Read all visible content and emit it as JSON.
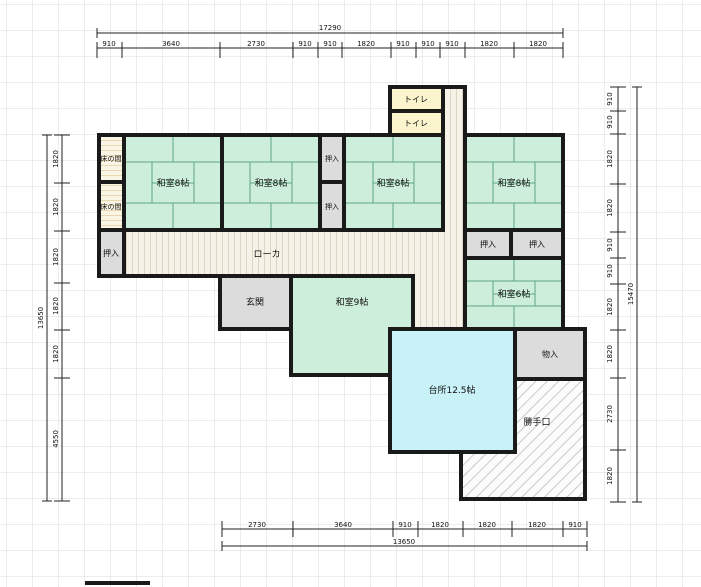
{
  "plan_type": "floor-plan",
  "rooms": {
    "toilet_1": "トイレ",
    "toilet_2": "トイレ",
    "tokonoma_1": "床の間",
    "tokonoma_2": "床の間",
    "washitsu8_1": "和室8帖",
    "washitsu8_2": "和室8帖",
    "washitsu8_3": "和室8帖",
    "washitsu8_4": "和室8帖",
    "oshiire_1": "押入",
    "oshiire_2": "押入",
    "oshiire_3": "押入",
    "oshiire_4": "押入",
    "oshiire_5": "押入",
    "corridor": "ローカ",
    "entrance": "玄関",
    "washitsu9": "和室9帖",
    "washitsu6": "和室6帖",
    "kitchen": "台所12.5帖",
    "storage": "物入",
    "backdoor": "勝手口"
  },
  "dimensions": {
    "top": {
      "total": "17290",
      "segments": [
        "910",
        "3640",
        "2730",
        "910",
        "910",
        "1820",
        "910",
        "910",
        "910",
        "1820",
        "1820"
      ]
    },
    "bottom": {
      "total": "13650",
      "segments": [
        "2730",
        "3640",
        "910",
        "1820",
        "1820",
        "1820",
        "910"
      ]
    },
    "left": {
      "total": "13650",
      "segments": [
        "1820",
        "1820",
        "1820",
        "1820",
        "1820",
        "4550"
      ]
    },
    "right": {
      "total": "15470",
      "segments": [
        "910",
        "910",
        "1820",
        "1820",
        "910",
        "910",
        "1820",
        "1820",
        "2730",
        "1820"
      ]
    }
  },
  "colors": {
    "tatami": "#cdeeda",
    "kitchen": "#c9f1f8",
    "toilet": "#faf5cd",
    "closet": "#dcdcdc",
    "wall": "#1a1a1a",
    "grid": "#d9d9d9",
    "corridor_bg": "#f6f2e7",
    "tokonoma_bg": "#fbf5e6"
  }
}
